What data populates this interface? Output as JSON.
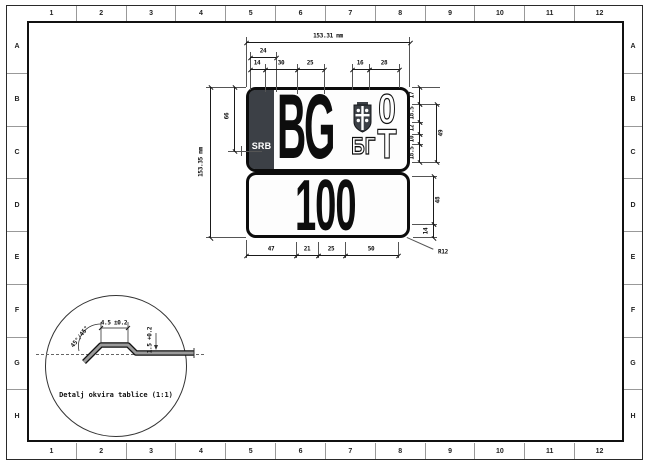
{
  "colors": {
    "band": "#3c4046",
    "line": "#1a1a1a",
    "paper": "#ffffff"
  },
  "sheet": {
    "grid_columns": [
      "1",
      "2",
      "3",
      "4",
      "5",
      "6",
      "7",
      "8",
      "9",
      "10",
      "11",
      "12"
    ],
    "grid_rows": [
      "A",
      "B",
      "C",
      "D",
      "E",
      "F",
      "G",
      "H"
    ]
  },
  "plate": {
    "country": "SRB",
    "city_code": "BG",
    "emblem": "serbian-coat-of-arms",
    "cyrillic_code": "БГ",
    "serial_top": "0",
    "serial_bottom": "T",
    "number": "100"
  },
  "dims": {
    "total_width": "153.31 mm",
    "top": {
      "d24": "24",
      "d14": "14",
      "d30": "30",
      "d25": "25",
      "d16": "16",
      "d28": "28"
    },
    "left": {
      "total_height": "153.35 mm",
      "d66": "66"
    },
    "right": {
      "d17": "17",
      "d18_5a": "18.5",
      "d12": "12",
      "d10": "10",
      "d18_5b": "18.5",
      "d49": "49",
      "d48": "48",
      "d14": "14",
      "radius": "R12"
    },
    "bottom": {
      "d47": "47",
      "d21": "21",
      "d25": "25",
      "d50": "50"
    }
  },
  "detail": {
    "label": "Detalj okvira tablice (1:1)",
    "plateau_width": "4.5 ±0.2",
    "thickness": "1.5 +0.2",
    "angle": "45°/45°"
  }
}
